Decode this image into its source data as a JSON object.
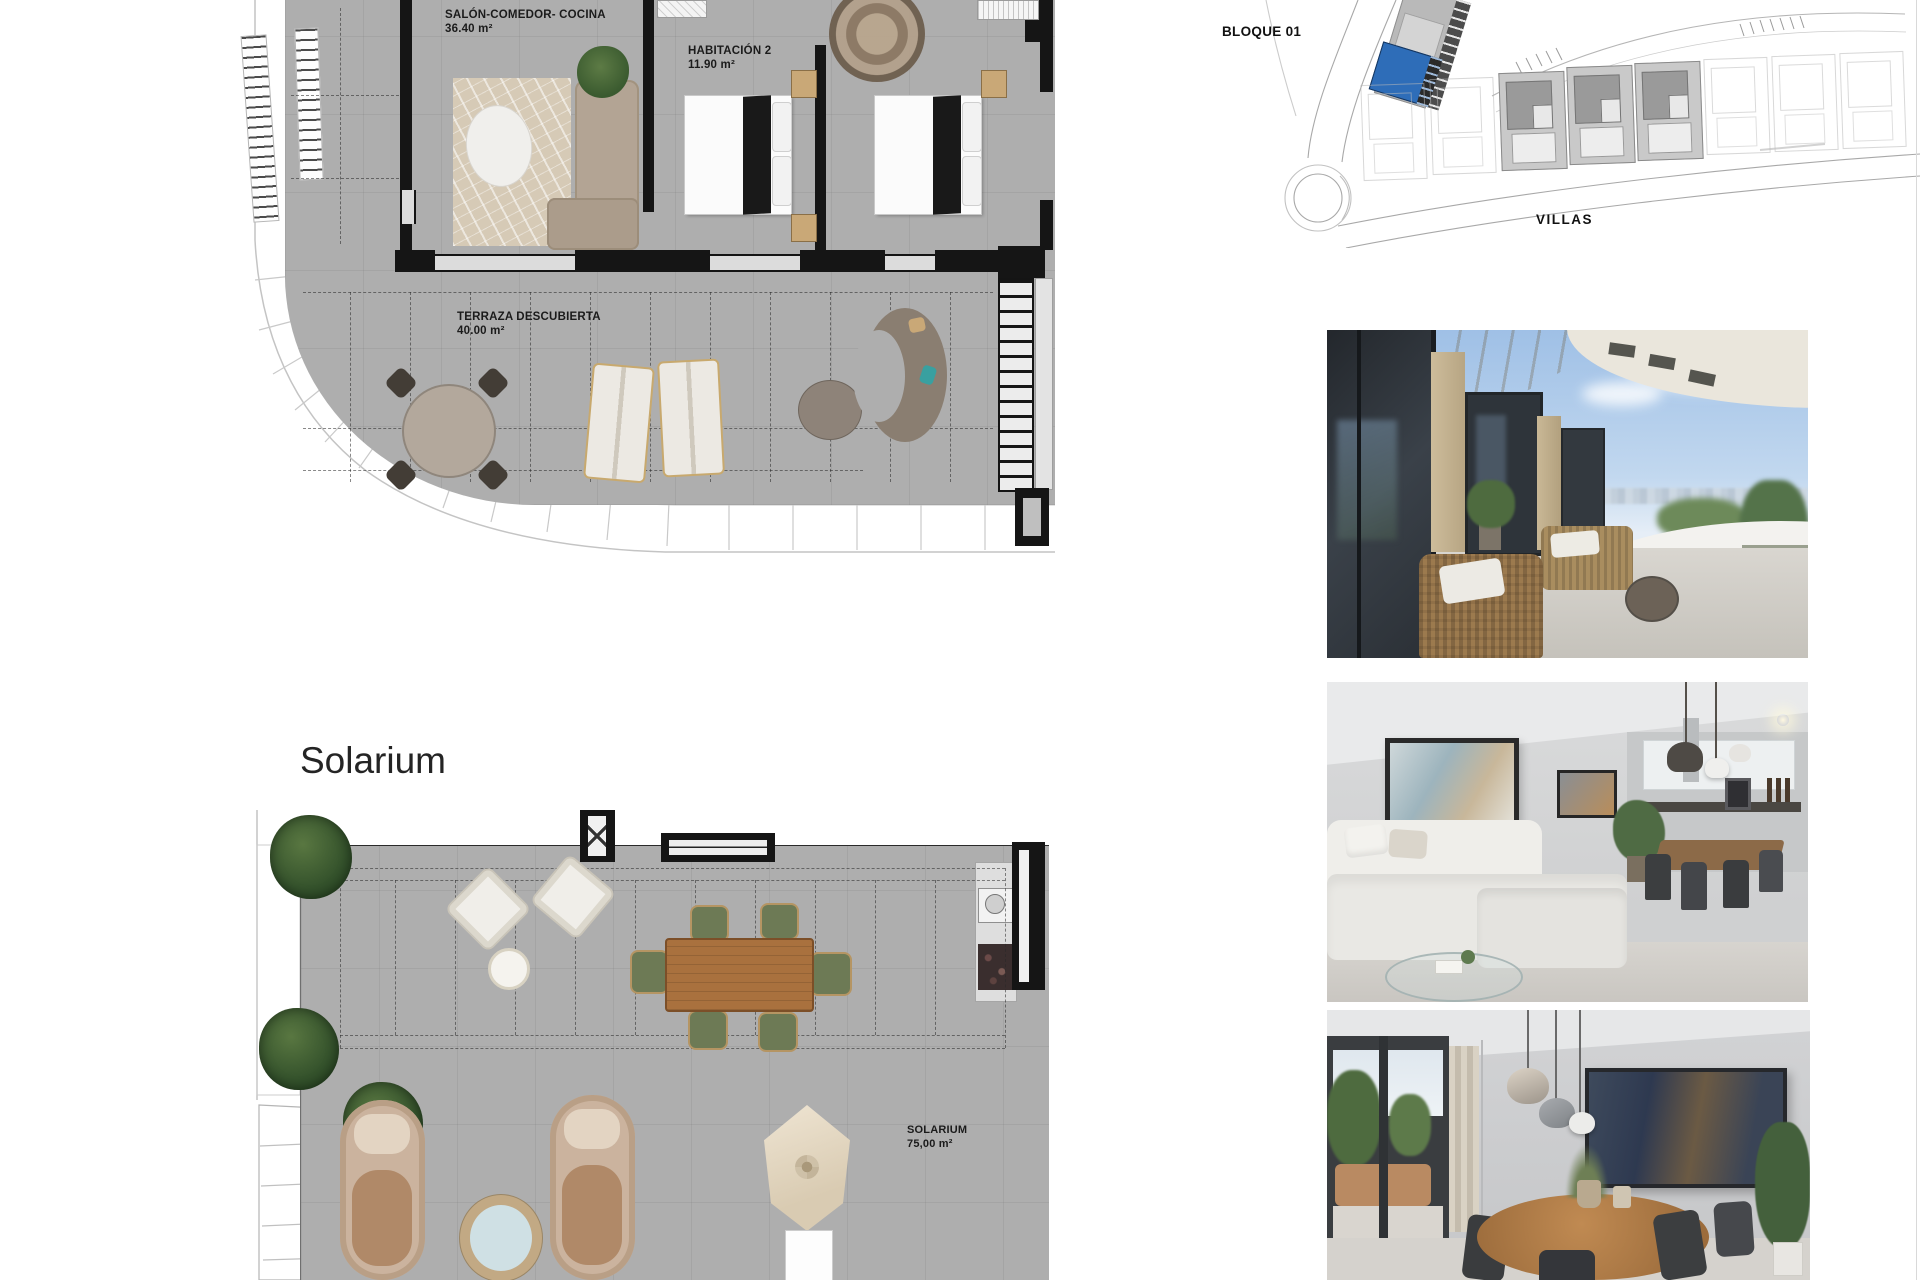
{
  "colors": {
    "accent_blue": "#2e6db8",
    "plan_gray": "#aeaeae",
    "wall_black": "#151515"
  },
  "floor_plan_upper": {
    "living_room": {
      "label": "SALÓN-COMEDOR- COCINA",
      "area": "36.40 m²"
    },
    "bedroom_2": {
      "label": "HABITACIÓN 2",
      "area": "11.90 m²"
    },
    "terrace": {
      "label": "TERRAZA DESCUBIERTA",
      "area": "40.00 m²"
    }
  },
  "floor_plan_solarium": {
    "title": "Solarium",
    "room": {
      "label": "SOLARIUM",
      "area": "75,00 m²"
    }
  },
  "site_plan": {
    "block_label": "BLOQUE 01",
    "villas_label": "VILLAS"
  }
}
